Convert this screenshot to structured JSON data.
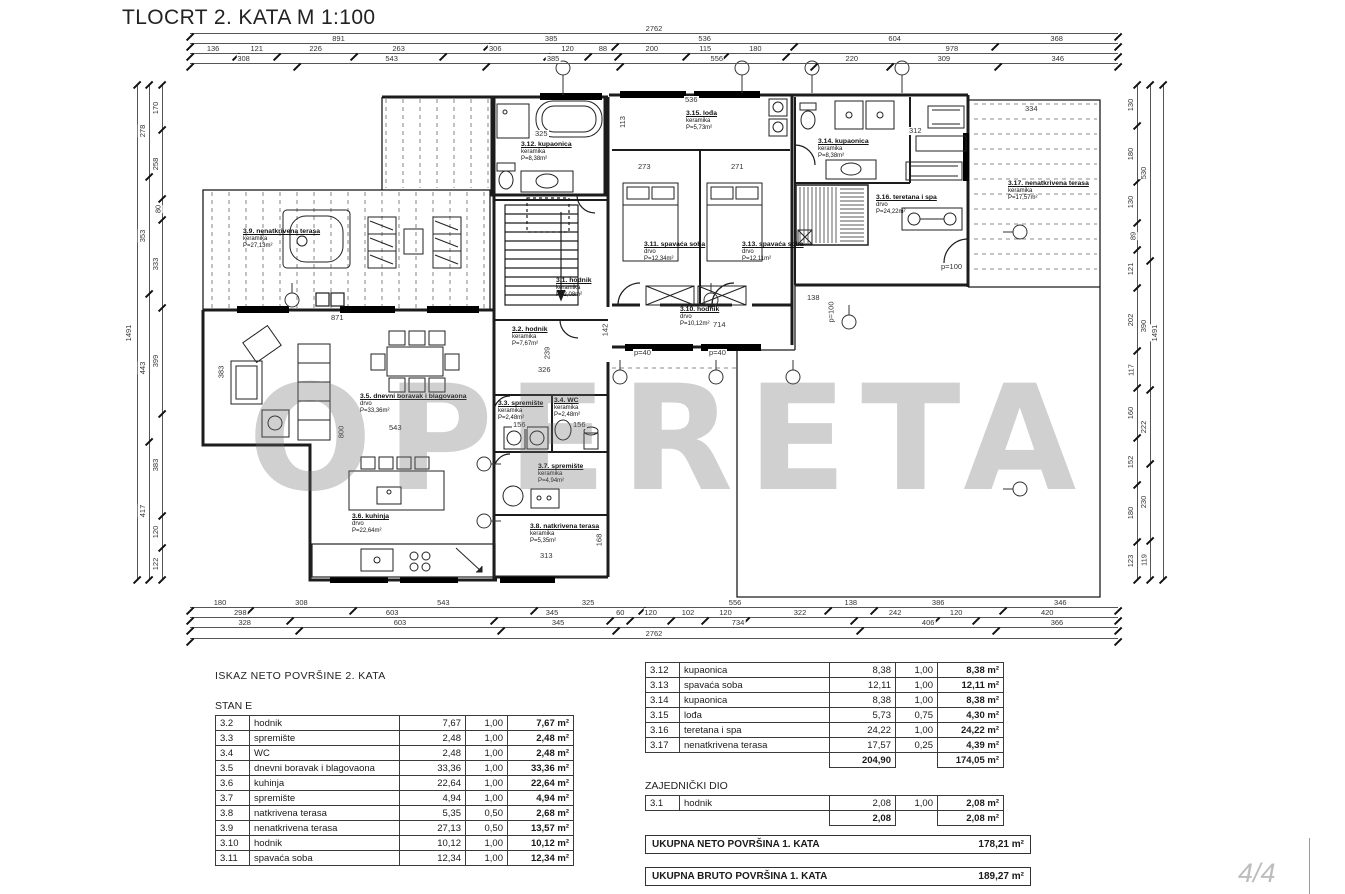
{
  "title": "TLOCRT 2. KATA M 1:100",
  "watermark": "OPERETA",
  "page_number": "4/4",
  "plan": {
    "rooms": [
      {
        "label": "3.9. nenatkrivena terasa",
        "material": "keramika",
        "area": "P=27,13m²"
      },
      {
        "label": "3.12. kupaonica",
        "material": "keramika",
        "area": "P=8,38m²"
      },
      {
        "label": "3.15. lođa",
        "material": "keramika",
        "area": "P=5,73m²"
      },
      {
        "label": "3.14. kupaonica",
        "material": "keramika",
        "area": "P=8,38m²"
      },
      {
        "label": "3.16. teretana i spa",
        "material": "drvo",
        "area": "P=24,22m²"
      },
      {
        "label": "3.17. nenatkrivena terasa",
        "material": "keramika",
        "area": "P=17,57m²"
      },
      {
        "label": "3.11. spavaća soba",
        "material": "drvo",
        "area": "P=12,34m²"
      },
      {
        "label": "3.13. spavaća soba",
        "material": "drvo",
        "area": "P=12,11m²"
      },
      {
        "label": "3.1. hodnik",
        "material": "keramika",
        "area": "P=2,08m²"
      },
      {
        "label": "3.10. hodnik",
        "material": "drvo",
        "area": "P=10,12m²"
      },
      {
        "label": "3.2. hodnik",
        "material": "keramika",
        "area": "P=7,67m²"
      },
      {
        "label": "3.5. dnevni boravak i blagovaona",
        "material": "drvo",
        "area": "P=33,36m²"
      },
      {
        "label": "3.6. kuhinja",
        "material": "drvo",
        "area": "P=22,64m²"
      },
      {
        "label": "3.3. spremište",
        "material": "keramika",
        "area": "P=2,48m²"
      },
      {
        "label": "3.4. WC",
        "material": "keramika",
        "area": "P=2,48m²"
      },
      {
        "label": "3.7. spremište",
        "material": "keramika",
        "area": "P=4,94m²"
      },
      {
        "label": "3.8. natkrivena terasa",
        "material": "keramika",
        "area": "P=5,35m²"
      }
    ],
    "inline": [
      "871",
      "543",
      "800",
      "383",
      "273",
      "271",
      "714",
      "138",
      "536",
      "113",
      "312",
      "334",
      "325",
      "326",
      "239",
      "313",
      "168",
      "156",
      "156",
      "p=40",
      "p=40",
      "p=100",
      "p=100",
      "142"
    ],
    "dims": {
      "top0": [
        "2762"
      ],
      "top1": [
        "891",
        "385",
        "536",
        "604",
        "368"
      ],
      "top2": [
        "136",
        "121",
        "226",
        "263",
        "306",
        "120",
        "88",
        "200",
        "115",
        "180",
        "978"
      ],
      "top3": [
        "308",
        "543",
        "385",
        "556",
        "220",
        "309",
        "346"
      ],
      "bot0": [
        "180",
        "308",
        "543",
        "325",
        "556",
        "138",
        "386",
        "346"
      ],
      "bot1": [
        "298",
        "603",
        "345",
        "60",
        "120",
        "102",
        "120",
        "322",
        "242",
        "120",
        "420"
      ],
      "bot2": [
        "328",
        "603",
        "345",
        "734",
        "406",
        "366"
      ],
      "bot3": [
        "2762"
      ],
      "left0": [
        "1491"
      ],
      "left1": [
        "278",
        "353",
        "443",
        "417"
      ],
      "left2": [
        "170",
        "258",
        "80",
        "333",
        "399",
        "383",
        "120",
        "122"
      ],
      "right0": [
        "130",
        "180",
        "130",
        "89",
        "121",
        "202",
        "117",
        "160",
        "152",
        "180",
        "123"
      ],
      "right1": [
        "530",
        "390",
        "222",
        "230",
        "119"
      ],
      "right2": [
        "1491"
      ]
    }
  },
  "tables": {
    "left": {
      "heading": "ISKAZ NETO POVRŠINE 2. KATA",
      "subheading": "STAN E",
      "rows": [
        [
          "3.2",
          "hodnik",
          "7,67",
          "1,00",
          "7,67 m²"
        ],
        [
          "3.3",
          "spremište",
          "2,48",
          "1,00",
          "2,48 m²"
        ],
        [
          "3.4",
          "WC",
          "2,48",
          "1,00",
          "2,48 m²"
        ],
        [
          "3.5",
          "dnevni boravak i blagovaona",
          "33,36",
          "1,00",
          "33,36 m²"
        ],
        [
          "3.6",
          "kuhinja",
          "22,64",
          "1,00",
          "22,64 m²"
        ],
        [
          "3.7",
          "spremište",
          "4,94",
          "1,00",
          "4,94 m²"
        ],
        [
          "3.8",
          "natkrivena terasa",
          "5,35",
          "0,50",
          "2,68 m²"
        ],
        [
          "3.9",
          "nenatkrivena terasa",
          "27,13",
          "0,50",
          "13,57 m²"
        ],
        [
          "3.10",
          "hodnik",
          "10,12",
          "1,00",
          "10,12 m²"
        ],
        [
          "3.11",
          "spavaća soba",
          "12,34",
          "1,00",
          "12,34 m²"
        ]
      ]
    },
    "right": {
      "rows": [
        [
          "3.12",
          "kupaonica",
          "8,38",
          "1,00",
          "8,38 m²"
        ],
        [
          "3.13",
          "spavaća soba",
          "12,11",
          "1,00",
          "12,11 m²"
        ],
        [
          "3.14",
          "kupaonica",
          "8,38",
          "1,00",
          "8,38 m²"
        ],
        [
          "3.15",
          "lođa",
          "5,73",
          "0,75",
          "4,30 m²"
        ],
        [
          "3.16",
          "teretana i spa",
          "24,22",
          "1,00",
          "24,22 m²"
        ],
        [
          "3.17",
          "nenatkrivena terasa",
          "17,57",
          "0,25",
          "4,39 m²"
        ]
      ],
      "totals": [
        [
          "",
          "",
          "204,90",
          "",
          "174,05 m²"
        ]
      ],
      "section2": "ZAJEDNIČKI DIO",
      "rows2": [
        [
          "3.1",
          "hodnik",
          "2,08",
          "1,00",
          "2,08 m²"
        ]
      ],
      "totals2": [
        [
          "",
          "",
          "2,08",
          "",
          "2,08 m²"
        ]
      ],
      "summary": [
        {
          "label": "UKUPNA NETO POVRŠINA 1. KATA",
          "value": "178,21 m²"
        },
        {
          "label": "UKUPNA BRUTO POVRŠINA 1. KATA",
          "value": "189,27 m²"
        }
      ]
    }
  }
}
